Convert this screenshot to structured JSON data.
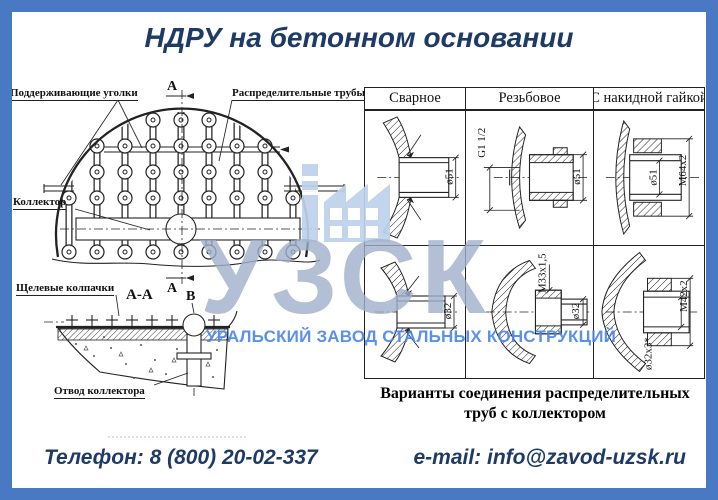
{
  "page": {
    "title": "НДРУ на бетонном основании"
  },
  "colors": {
    "frame_blue": "#4a79c4",
    "heading_navy": "#1e3a66",
    "drawing_ink": "#222222",
    "watermark_acronym_gray": "#9fb0ca",
    "watermark_name_blue": "#4a86e8",
    "watermark_icon_blue": "#bed2ec"
  },
  "diagram": {
    "labels": {
      "supporting_angles": "Поддерживающие уголки",
      "distribution_pipes": "Распределительные трубы",
      "collector": "Коллектор",
      "section_marker_top": "А",
      "section_marker_bottom": "А",
      "slot_caps": "Щелевые колпачки",
      "section_title": "А-А",
      "detail_marker": "В",
      "collector_outlet": "Отвод коллектора"
    }
  },
  "table": {
    "headers": [
      "Сварное",
      "Резьбовое",
      "С накидной гайкой"
    ],
    "rows": [
      {
        "cells": [
          {
            "dims": [
              "ø51"
            ]
          },
          {
            "dims": [
              "G1 1/2",
              "ø51"
            ]
          },
          {
            "dims": [
              "ø51",
              "M64x2"
            ]
          }
        ]
      },
      {
        "cells": [
          {
            "dims": [
              "ø32"
            ]
          },
          {
            "dims": [
              "M33x1,5",
              "ø32"
            ]
          },
          {
            "dims": [
              "ø32x3*",
              "M42x2"
            ]
          }
        ]
      }
    ],
    "caption": "Варианты соединения распределительных труб с коллектором"
  },
  "watermark": {
    "acronym": "УЗСК",
    "full_name": "УРАЛЬСКИЙ ЗАВОД СТАЛЬНЫХ КОНСТРУКЦИЙ",
    "icon": "factory-icon"
  },
  "footer": {
    "phone": "Телефон: 8 (800) 20-02-337",
    "email": "e-mail: info@zavod-uzsk.ru"
  }
}
